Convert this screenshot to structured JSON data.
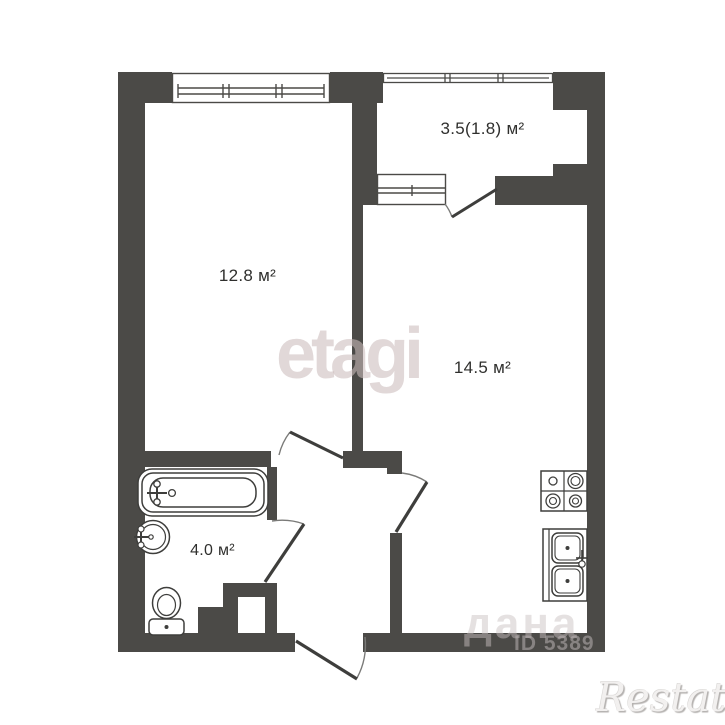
{
  "plan": {
    "rooms": {
      "living": {
        "label": "12.8 м²"
      },
      "kitchen": {
        "label": "14.5 м²"
      },
      "balcony": {
        "label": "3.5(1.8) м²"
      },
      "bathroom": {
        "label": "4.0 м²"
      }
    },
    "watermarks": {
      "center": "etagi",
      "bottom_text": "дана",
      "bottom_id": "ID 5389",
      "brand": "Restate"
    },
    "colors": {
      "wall": "#4b4a47",
      "fixture": "#3e3e3c",
      "label": "#2f2f2d",
      "watermark": "#cbbcbc"
    }
  }
}
